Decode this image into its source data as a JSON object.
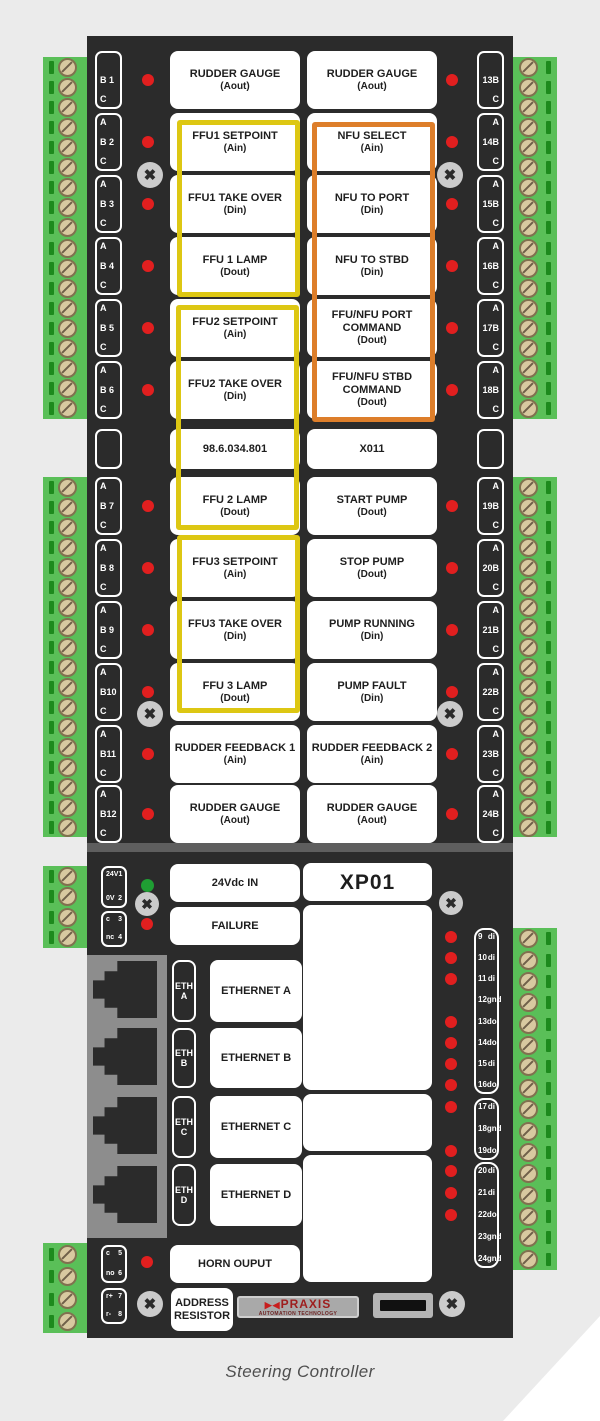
{
  "caption": "Steering Controller",
  "colors": {
    "panel": "#2b2b2b",
    "highlight_yellow": "#ddc713",
    "highlight_orange": "#dd7e2a",
    "led_red": "#e11f1f",
    "led_green": "#1f9e33",
    "green_strip": "#5abf58"
  },
  "main_panel": {
    "rows": [
      {
        "type": "io",
        "left_term": [
          "",
          "B 1",
          "C"
        ],
        "left": {
          "title": "RUDDER GAUGE",
          "sub": "(Aout)"
        },
        "right": {
          "title": "RUDDER GAUGE",
          "sub": "(Aout)"
        },
        "right_term": [
          "",
          "13B",
          "C"
        ]
      },
      {
        "type": "io",
        "left_term": [
          "A",
          "B 2",
          "C"
        ],
        "left": {
          "title": "FFU1 SETPOINT",
          "sub": "(Ain)"
        },
        "right": {
          "title": "NFU SELECT",
          "sub": "(Ain)"
        },
        "right_term": [
          "A",
          "14B",
          "C"
        ]
      },
      {
        "type": "io",
        "left_term": [
          "A",
          "B 3",
          "C"
        ],
        "left": {
          "title": "FFU1 TAKE OVER",
          "sub": "(Din)"
        },
        "right": {
          "title": "NFU TO PORT",
          "sub": "(Din)"
        },
        "right_term": [
          "A",
          "15B",
          "C"
        ]
      },
      {
        "type": "io",
        "left_term": [
          "A",
          "B 4",
          "C"
        ],
        "left": {
          "title": "FFU 1 LAMP",
          "sub": "(Dout)"
        },
        "right": {
          "title": "NFU TO STBD",
          "sub": "(Din)"
        },
        "right_term": [
          "A",
          "16B",
          "C"
        ]
      },
      {
        "type": "io",
        "left_term": [
          "A",
          "B 5",
          "C"
        ],
        "left": {
          "title": "FFU2 SETPOINT",
          "sub": "(Ain)"
        },
        "right": {
          "title": "FFU/NFU PORT COMMAND",
          "sub": "(Dout)"
        },
        "right_term": [
          "A",
          "17B",
          "C"
        ]
      },
      {
        "type": "io",
        "left_term": [
          "A",
          "B 6",
          "C"
        ],
        "left": {
          "title": "FFU2 TAKE OVER",
          "sub": "(Din)"
        },
        "right": {
          "title": "FFU/NFU STBD COMMAND",
          "sub": "(Dout)"
        },
        "right_term": [
          "A",
          "18B",
          "C"
        ]
      },
      {
        "type": "id",
        "left_term": [
          "",
          "",
          ""
        ],
        "left": {
          "title": "98.6.034.801",
          "sub": ""
        },
        "right": {
          "title": "X011",
          "sub": ""
        },
        "right_term": [
          "",
          "",
          ""
        ]
      },
      {
        "type": "io",
        "left_term": [
          "A",
          "B 7",
          "C"
        ],
        "left": {
          "title": "FFU 2 LAMP",
          "sub": "(Dout)"
        },
        "right": {
          "title": "START PUMP",
          "sub": "(Dout)"
        },
        "right_term": [
          "A",
          "19B",
          "C"
        ]
      },
      {
        "type": "io",
        "left_term": [
          "A",
          "B 8",
          "C"
        ],
        "left": {
          "title": "FFU3 SETPOINT",
          "sub": "(Ain)"
        },
        "right": {
          "title": "STOP PUMP",
          "sub": "(Dout)"
        },
        "right_term": [
          "A",
          "20B",
          "C"
        ]
      },
      {
        "type": "io",
        "left_term": [
          "A",
          "B 9",
          "C"
        ],
        "left": {
          "title": "FFU3 TAKE OVER",
          "sub": "(Din)"
        },
        "right": {
          "title": "PUMP RUNNING",
          "sub": "(Din)"
        },
        "right_term": [
          "A",
          "21B",
          "C"
        ]
      },
      {
        "type": "io",
        "left_term": [
          "A",
          "B10",
          "C"
        ],
        "left": {
          "title": "FFU 3 LAMP",
          "sub": "(Dout)"
        },
        "right": {
          "title": "PUMP FAULT",
          "sub": "(Din)"
        },
        "right_term": [
          "A",
          "22B",
          "C"
        ]
      },
      {
        "type": "io",
        "left_term": [
          "A",
          "B11",
          "C"
        ],
        "left": {
          "title": "RUDDER FEEDBACK 1",
          "sub": "(Ain)"
        },
        "right": {
          "title": "RUDDER FEEDBACK 2",
          "sub": "(Ain)"
        },
        "right_term": [
          "A",
          "23B",
          "C"
        ]
      },
      {
        "type": "io",
        "left_term": [
          "A",
          "B12",
          "C"
        ],
        "left": {
          "title": "RUDDER GAUGE",
          "sub": "(Aout)"
        },
        "right": {
          "title": "RUDDER GAUGE",
          "sub": "(Aout)"
        },
        "right_term": [
          "A",
          "24B",
          "C"
        ]
      }
    ],
    "groups": [
      {
        "name": "ffu1-group",
        "color": "yellow"
      },
      {
        "name": "ffu2-group",
        "color": "yellow"
      },
      {
        "name": "ffu3-group",
        "color": "yellow"
      },
      {
        "name": "nfu-group",
        "color": "orange"
      }
    ]
  },
  "bottom_panel": {
    "module_id": "XP01",
    "power_label": "24Vdc IN",
    "failure_label": "FAILURE",
    "horn_label": "HORN OUPUT",
    "address_resistor": [
      "ADDRESS",
      "RESISTOR"
    ],
    "power_term": [
      [
        "24V",
        "1"
      ],
      [
        "0V",
        "2"
      ]
    ],
    "aux_term": [
      [
        "c",
        "3"
      ],
      [
        "nc",
        "4"
      ]
    ],
    "horn_term": [
      [
        "c",
        "5"
      ],
      [
        "no",
        "6"
      ]
    ],
    "resistor_term": [
      [
        "r+",
        "7"
      ],
      [
        "r-",
        "8"
      ]
    ],
    "eth_ports": [
      {
        "tag": [
          "ETH",
          "A"
        ],
        "label": "ETHERNET A"
      },
      {
        "tag": [
          "ETH",
          "B"
        ],
        "label": "ETHERNET B"
      },
      {
        "tag": [
          "ETH",
          "C"
        ],
        "label": "ETHERNET C"
      },
      {
        "tag": [
          "ETH",
          "D"
        ],
        "label": "ETHERNET D"
      }
    ],
    "pin_groups": [
      {
        "pins": [
          {
            "n": "9",
            "t": "di",
            "led": true
          },
          {
            "n": "10",
            "t": "di",
            "led": true
          },
          {
            "n": "11",
            "t": "di",
            "led": true
          },
          {
            "n": "12",
            "t": "gnd",
            "led": false
          },
          {
            "n": "13",
            "t": "do",
            "led": true
          },
          {
            "n": "14",
            "t": "do",
            "led": true
          },
          {
            "n": "15",
            "t": "di",
            "led": true
          },
          {
            "n": "16",
            "t": "do",
            "led": true
          }
        ]
      },
      {
        "pins": [
          {
            "n": "17",
            "t": "di",
            "led": true
          },
          {
            "n": "18",
            "t": "gnd",
            "led": false
          },
          {
            "n": "19",
            "t": "do",
            "led": true
          }
        ]
      },
      {
        "pins": [
          {
            "n": "20",
            "t": "di",
            "led": true
          },
          {
            "n": "21",
            "t": "di",
            "led": true
          },
          {
            "n": "22",
            "t": "do",
            "led": true
          },
          {
            "n": "23",
            "t": "gnd",
            "led": false
          },
          {
            "n": "24",
            "t": "gnd",
            "led": false
          }
        ]
      }
    ],
    "brand": {
      "icon": "▶◀",
      "name": "PRAXIS",
      "tagline": "AUTOMATION TECHNOLOGY"
    }
  }
}
